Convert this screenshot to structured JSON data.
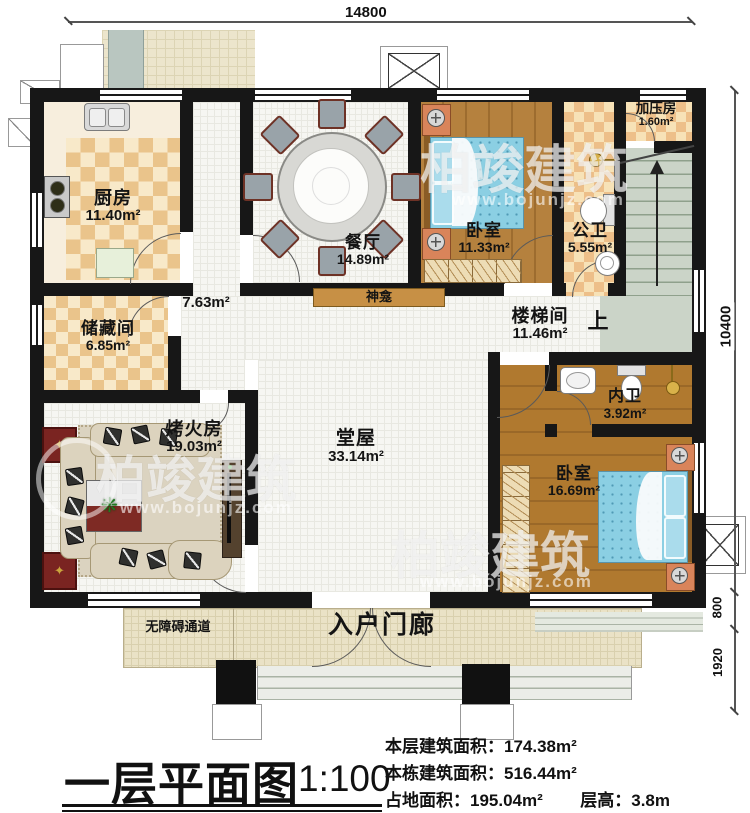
{
  "title": {
    "text": "一层平面图",
    "scale": "1:100"
  },
  "dimensions": {
    "top": "14800",
    "right_upper": "10400",
    "right_mid": "800",
    "right_lower": "1920"
  },
  "rooms": {
    "kitchen": {
      "name": "厨房",
      "area": "11.40m²"
    },
    "dining": {
      "name": "餐厅",
      "area": "14.89m²"
    },
    "bedroom_top": {
      "name": "卧室",
      "area": "11.33m²"
    },
    "pressure": {
      "name": "加压房",
      "area": "1.60m²"
    },
    "public_bath": {
      "name": "公卫",
      "area": "5.55m²"
    },
    "stair_hall": {
      "name": "楼梯间",
      "area": "11.46m²"
    },
    "hallway": {
      "area": "7.63m²"
    },
    "storage": {
      "name": "储藏间",
      "area": "6.85m²"
    },
    "fire_room": {
      "name": "烤火房",
      "area": "19.03m²"
    },
    "main_hall": {
      "name": "堂屋",
      "area": "33.14m²"
    },
    "ensuite_bath": {
      "name": "内卫",
      "area": "3.92m²"
    },
    "bedroom_bottom": {
      "name": "卧室",
      "area": "16.69m²"
    }
  },
  "annotations": {
    "shrine": "神龛",
    "up": "上",
    "ramp": "无障碍通道",
    "porch": "入户门廊"
  },
  "stats": {
    "floor_area_label": "本层建筑面积：",
    "floor_area": "174.38m²",
    "building_area_label": "本栋建筑面积：",
    "building_area": "516.44m²",
    "footprint_label": "占地面积：",
    "footprint": "195.04m²",
    "height_label": "层高：",
    "height": "3.8m"
  },
  "watermark": {
    "brand": "柏竣建筑",
    "url": "www.bojunjz.com"
  },
  "colors": {
    "wall": "#171717",
    "wood": "#b5813e",
    "bed": "#8bcfe3",
    "stairs": "#cbd4c8",
    "checker": "#eac48b",
    "porch": "#eae2c6",
    "accent_red": "#7a2421"
  }
}
